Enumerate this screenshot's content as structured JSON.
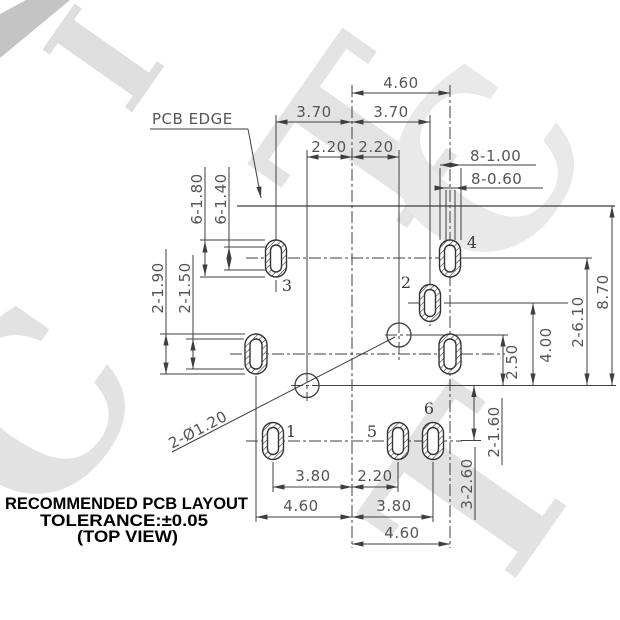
{
  "title_block": {
    "line1": "RECOMMENDED PCB LAYOUT",
    "line2": "TOLERANCE:±0.05",
    "line3": "(TOP VIEW)"
  },
  "labels": {
    "pcb_edge": "PCB EDGE",
    "hole_callout": "2-Ø1.20",
    "pad1": "1",
    "pad2": "2",
    "pad3": "3",
    "pad4": "4",
    "pad5": "5",
    "pad6": "6"
  },
  "dims": {
    "top_overall": "4.60",
    "top_left": "3.70",
    "top_right": "3.70",
    "top_inner_left": "2.20",
    "top_inner_right": "2.20",
    "pads_width_outer": "8-1.00",
    "pads_width_inner": "8-0.60",
    "side_height_outer": "6-1.80",
    "side_height_inner": "6-1.40",
    "mid_height_outer": "2-1.90",
    "mid_height_inner": "2-1.50",
    "right_circles": "2.50",
    "right_pad2": "4.00",
    "right_pads34": "2-6.10",
    "right_overall": "8.70",
    "lowright_inner": "2-1.60",
    "lowright_outer": "3-2.60",
    "bot_r1_left": "3.80",
    "bot_r1_right": "2.20",
    "bot_r2_left": "4.60",
    "bot_r2_right": "3.80",
    "bot_r3": "4.60"
  },
  "watermark": {
    "l1": "I",
    "l2": "T",
    "l3": "C",
    "l4": "C",
    "l5": "T"
  },
  "colors": {
    "line": "#3f3f3f",
    "dim_text": "#555555",
    "title_text": "#000000",
    "pad_stroke": "#333333",
    "watermark_light": "#e2e2e2",
    "watermark_dark": "#c4c4c4"
  }
}
